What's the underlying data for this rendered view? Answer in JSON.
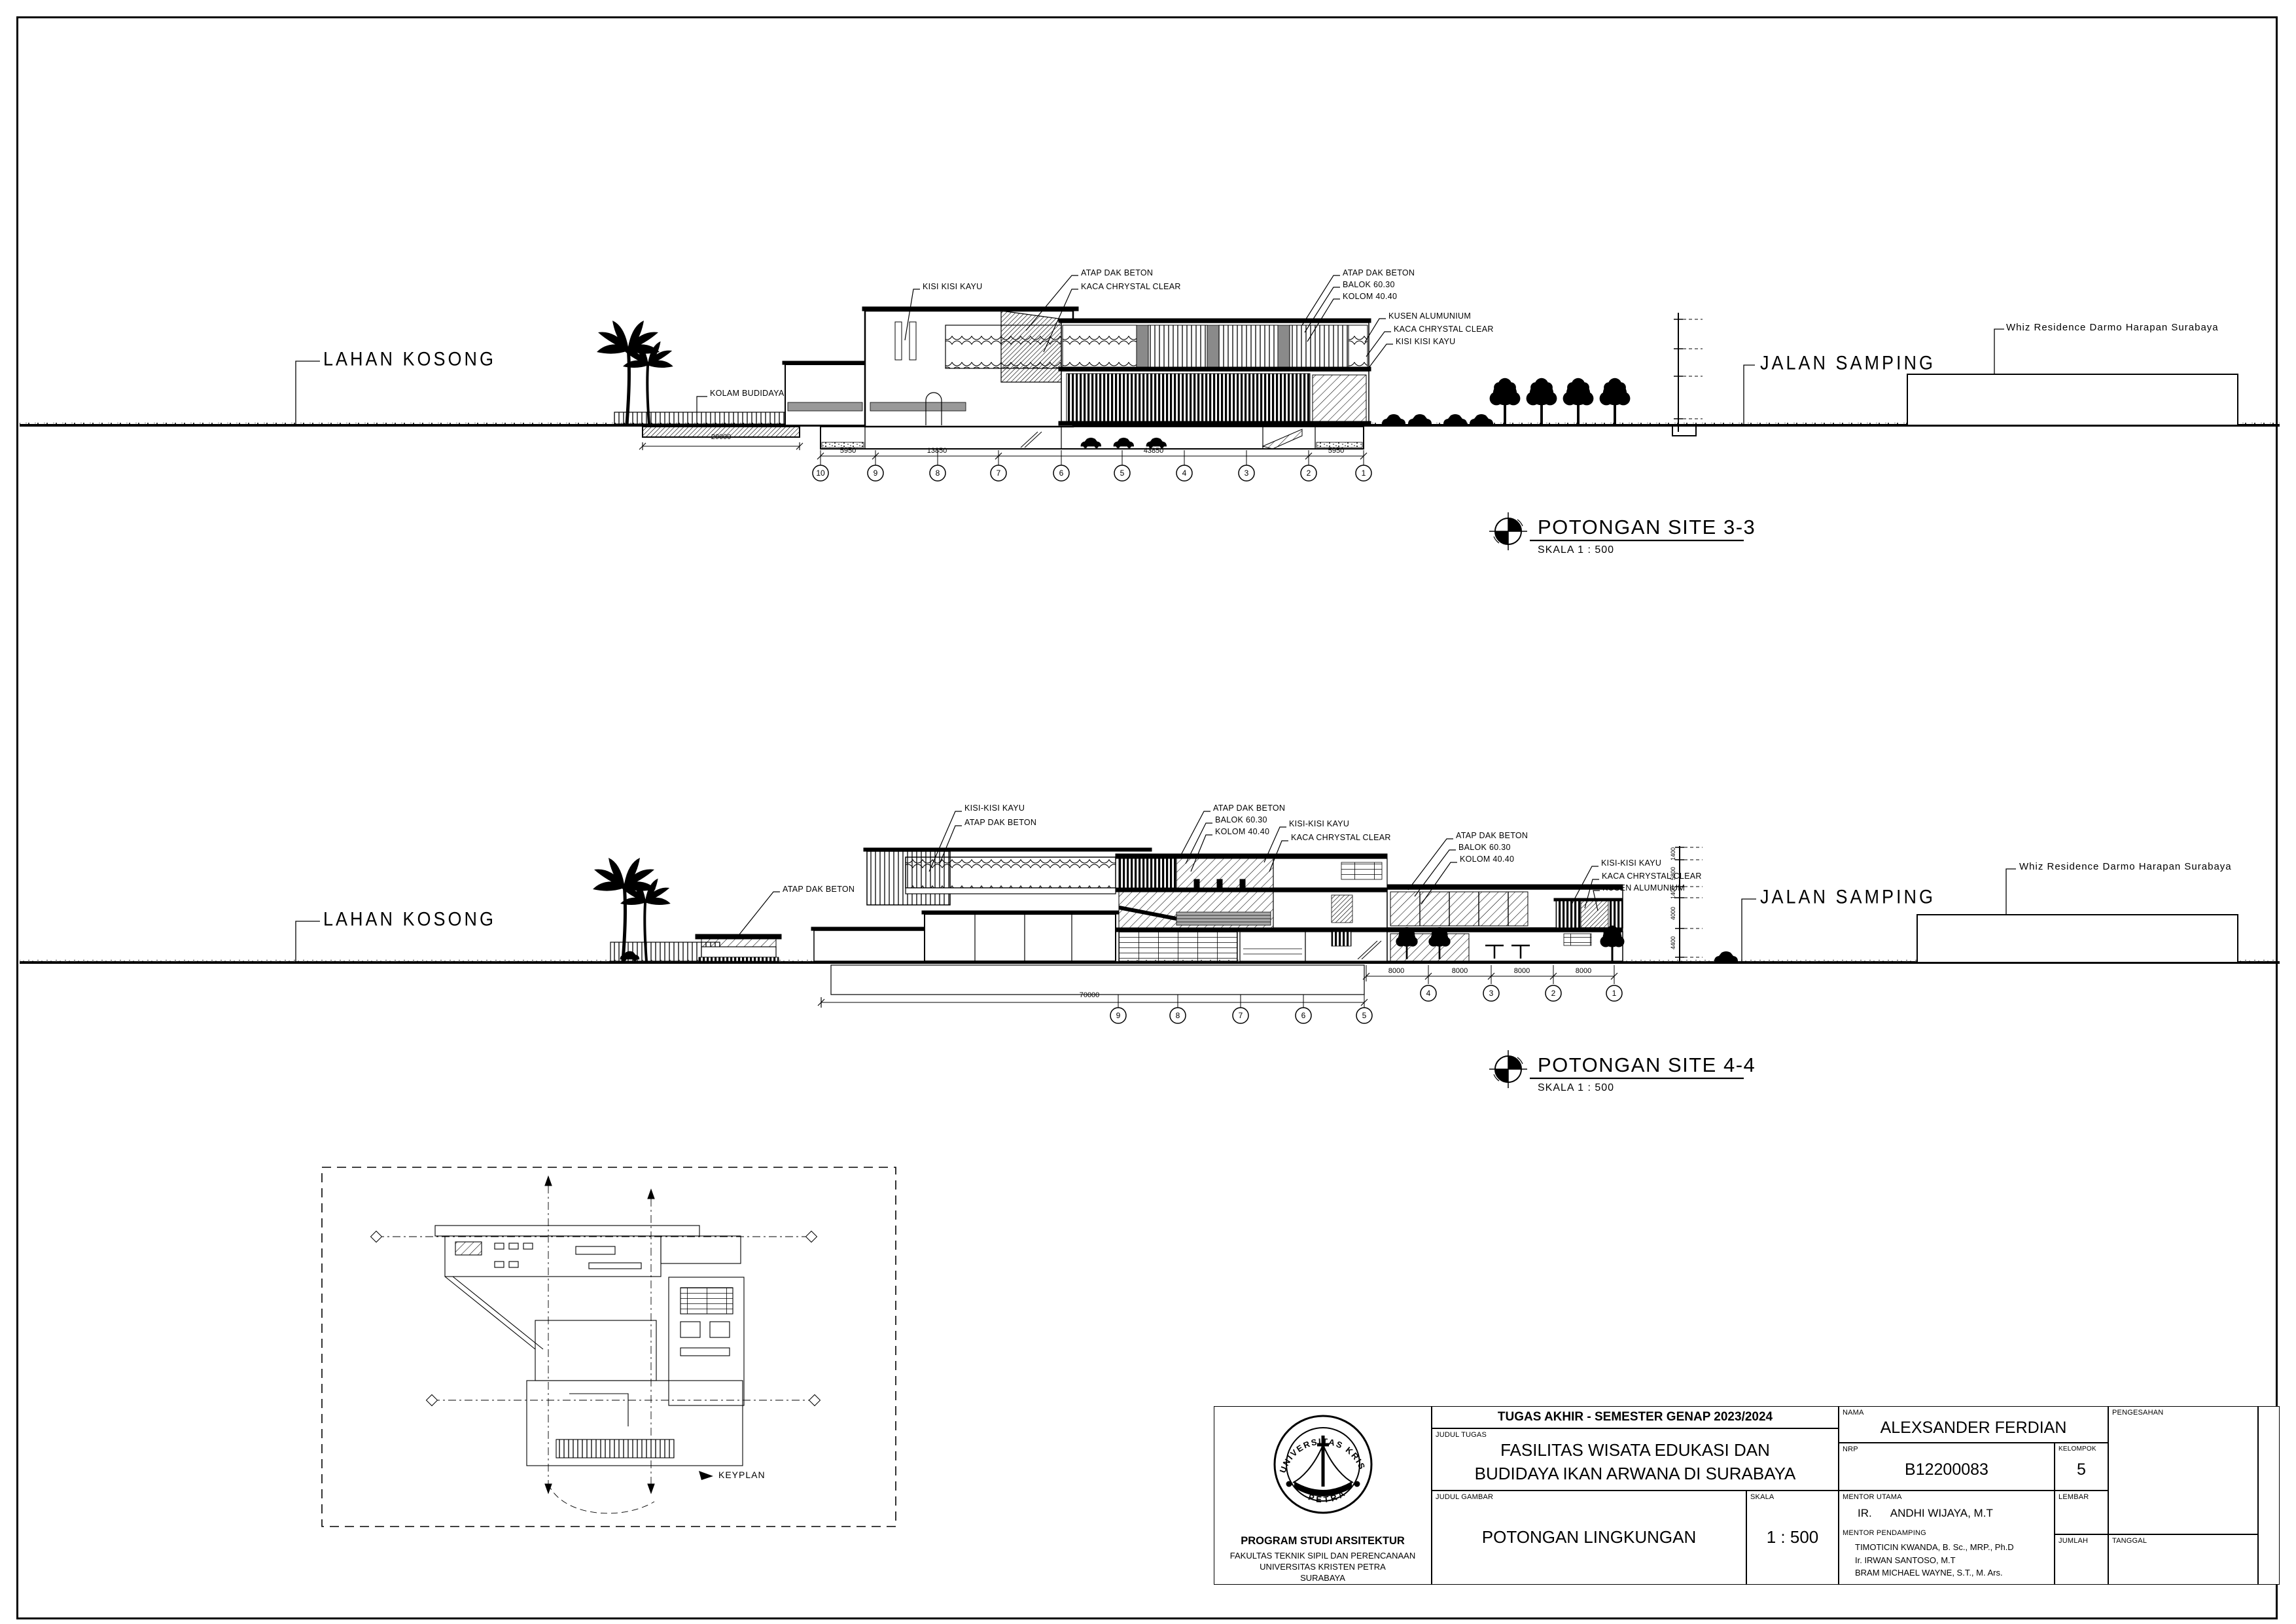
{
  "sections": {
    "s33": {
      "title": "POTONGAN SITE 3-3",
      "scale": "SKALA 1 : 500",
      "lahan_kosong": "LAHAN KOSONG",
      "kolam_budidaya": "KOLAM BUDIDAYA",
      "kolam_dim": "20000",
      "jalan_samping": "JALAN SAMPING",
      "whiz": "Whiz Residence Darmo Harapan Surabaya",
      "callouts_mid": [
        "KISI KISI KAYU",
        "ATAP DAK BETON",
        "KACA CHRYSTAL CLEAR"
      ],
      "callouts_rt": [
        "ATAP DAK BETON",
        "BALOK 60.30",
        "KOLOM 40.40"
      ],
      "callouts_r": [
        "KUSEN ALUMUNIUM",
        "KACA CHRYSTAL CLEAR",
        "KISI KISI KAYU"
      ],
      "grid": [
        "10",
        "9",
        "8",
        "7",
        "6",
        "5",
        "4",
        "3",
        "2",
        "1"
      ],
      "dims": [
        "5950",
        "13850",
        "43850",
        "5950"
      ]
    },
    "s44": {
      "title": "POTONGAN SITE 4-4",
      "scale": "SKALA 1 : 500",
      "lahan_kosong": "LAHAN KOSONG",
      "jalan_samping": "JALAN SAMPING",
      "whiz": "Whiz Residence Darmo Harapan Surabaya",
      "callouts_left": [
        "KISI-KISI KAYU",
        "ATAP DAK BETON"
      ],
      "callout_pavilion": "ATAP DAK BETON",
      "callouts_mid": [
        "ATAP DAK BETON",
        "BALOK 60.30",
        "KOLOM 40.40"
      ],
      "callouts_mid2": [
        "KISI-KISI KAYU",
        "KACA CHRYSTAL CLEAR"
      ],
      "callouts_rt": [
        "ATAP DAK BETON",
        "BALOK 60.30",
        "KOLOM 40.40"
      ],
      "callouts_r": [
        "KISI-KISI KAYU",
        "KACA CHRYSTAL CLEAR",
        "KUSEN ALUMUNIUM"
      ],
      "grid_left": [
        "9",
        "8",
        "7",
        "6",
        "5"
      ],
      "dim_left": "70000",
      "grid_right": [
        "4",
        "3",
        "2",
        "1"
      ],
      "dims_right": [
        "8000",
        "8000",
        "8000",
        "8000"
      ],
      "staff_dims": [
        "1400",
        "5800",
        "1400",
        "4000",
        "4400"
      ]
    }
  },
  "keyplan": {
    "label": "KEYPLAN"
  },
  "titleblock": {
    "header": "TUGAS AKHIR - SEMESTER GENAP 2023/2024",
    "labels": {
      "judul_tugas": "JUDUL TUGAS",
      "judul_gambar": "JUDUL GAMBAR",
      "skala": "SKALA",
      "nama": "NAMA",
      "nrp": "NRP",
      "kelompok": "KELOMPOK",
      "mentor_utama": "MENTOR UTAMA",
      "mentor_pendamping": "MENTOR PENDAMPING",
      "lembar": "LEMBAR",
      "jumlah": "JUMLAH",
      "tanggal": "TANGGAL",
      "pengesahan": "PENGESAHAN"
    },
    "values": {
      "judul_tugas_1": "FASILITAS WISATA EDUKASI DAN",
      "judul_tugas_2": "BUDIDAYA IKAN ARWANA DI SURABAYA",
      "judul_gambar": "POTONGAN LINGKUNGAN",
      "skala": "1 : 500",
      "nama": "ALEXSANDER FERDIAN",
      "nrp": "B12200083",
      "kelompok": "5",
      "mentor_utama_prefix": "IR.",
      "mentor_utama_name": "ANDHI WIJAYA, M.T",
      "mentors": [
        "TIMOTICIN KWANDA, B. Sc., MRP., Ph.D",
        "Ir. IRWAN SANTOSO, M.T",
        "BRAM MICHAEL WAYNE, S.T., M. Ars."
      ]
    },
    "institution": {
      "program": "PROGRAM STUDI ARSITEKTUR",
      "fakultas": "FAKULTAS TEKNIK SIPIL DAN PERENCANAAN",
      "universitas": "UNIVERSITAS KRISTEN PETRA",
      "kota": "SURABAYA"
    },
    "logo": {
      "top": "UNIVERSITAS KRISTEN",
      "bottom": "PETRA"
    }
  }
}
